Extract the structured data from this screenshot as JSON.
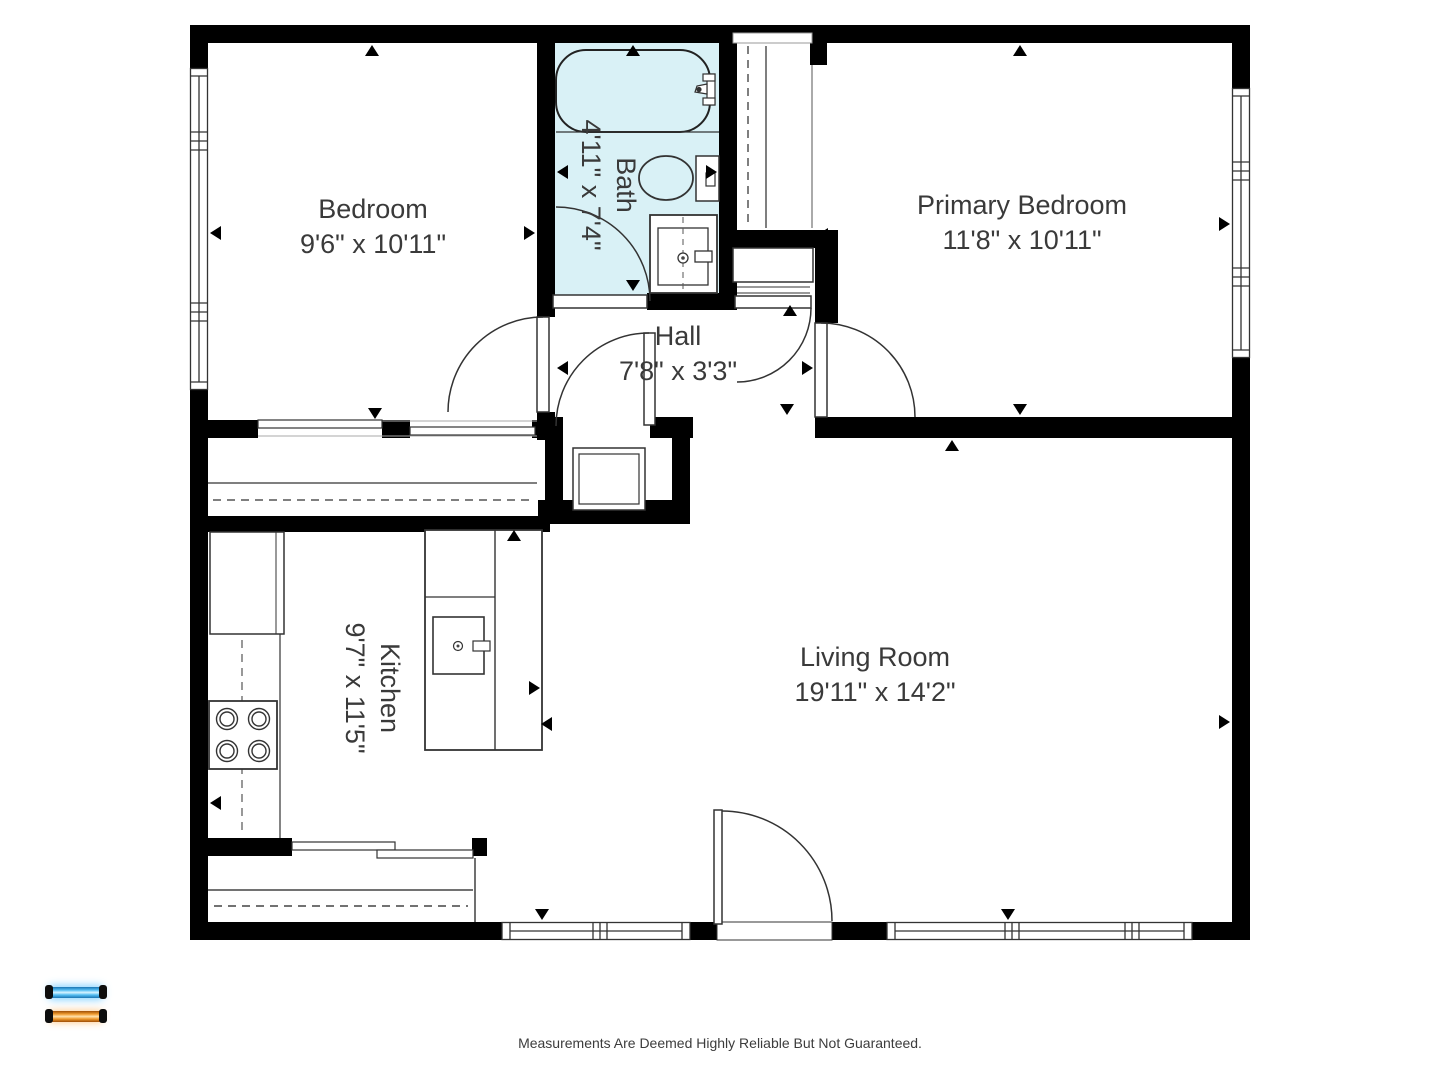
{
  "floorplan": {
    "rooms": [
      {
        "name": "Bedroom",
        "dimensions": "9'6\" x 10'11\""
      },
      {
        "name": "Bath",
        "dimensions": "4'11\" x 7'4\""
      },
      {
        "name": "Primary Bedroom",
        "dimensions": "11'8\" x 10'11\""
      },
      {
        "name": "Hall",
        "dimensions": "7'8\" x 3'3\""
      },
      {
        "name": "Kitchen",
        "dimensions": "9'7\" x 11'5\""
      },
      {
        "name": "Living Room",
        "dimensions": "19'11\" x 14'2\""
      }
    ],
    "colors": {
      "wall": "#000000",
      "bath_fill": "#d9f1f6",
      "line": "#333333",
      "text": "#3a3a3a"
    }
  },
  "legend": {
    "floor_buttons": [
      {
        "id": "floor-upper",
        "color": "#3fa9e8"
      },
      {
        "id": "floor-lower",
        "color": "#e8861c"
      }
    ]
  },
  "footer": {
    "disclaimer": "Measurements Are Deemed Highly Reliable But Not Guaranteed."
  }
}
